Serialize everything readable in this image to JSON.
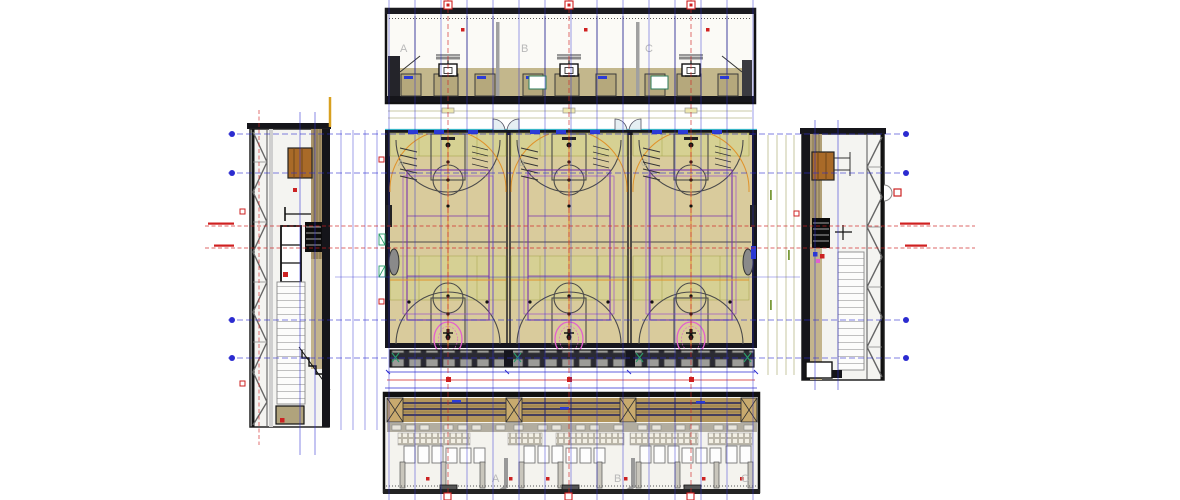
{
  "drawing": {
    "type": "architectural-cad-sheet",
    "subject": "sports-hall-with-three-courts-plan-and-four-elevations",
    "views": {
      "top_elevation": {
        "labels": [
          "A",
          "B",
          "C"
        ]
      },
      "plan": {
        "court_labels": [
          "A",
          "B",
          "C"
        ]
      },
      "bottom_elevation": {
        "labels": [
          "A",
          "B",
          "C"
        ]
      }
    },
    "colors": {
      "floor_tan": "#d9cb9c",
      "zone_green": "#d6d293",
      "wall_dark": "#16161e",
      "grid_blue": "#2b2bd0",
      "grid_red": "#d02020",
      "court_purple": "#7a35ad",
      "court_orange": "#e0922a",
      "hoop_pink": "#e35fd0",
      "cyan_line": "#38b6c8",
      "wood_brown": "#a96a28",
      "slat_band": "#b3965c"
    }
  }
}
